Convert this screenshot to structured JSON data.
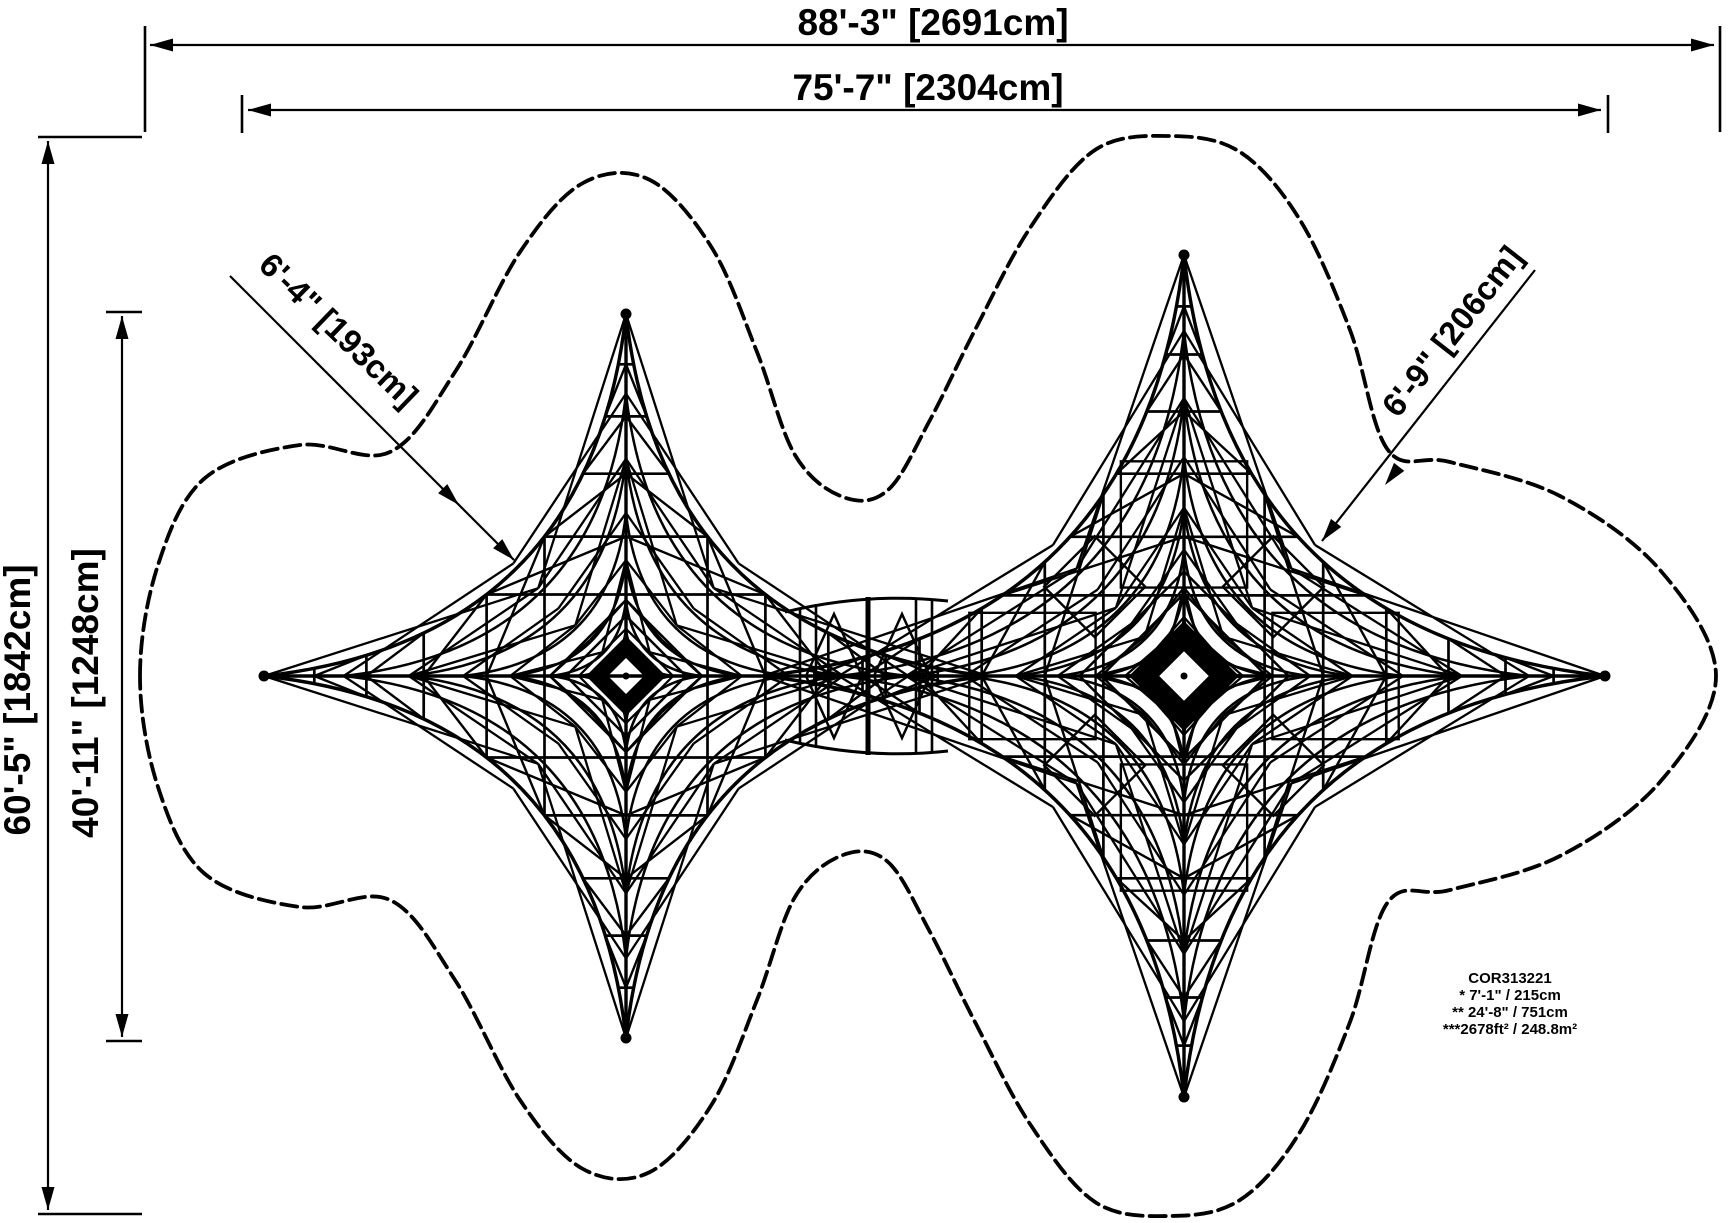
{
  "colors": {
    "ink": "#000000",
    "background": "#ffffff"
  },
  "dimensions": {
    "overall_width": "88'-3\" [2691cm]",
    "net_span_width": "75'-7\" [2304cm]",
    "overall_height": "60'-5\" [1842cm]",
    "net_span_height": "40'-11\" [1248cm]",
    "clearance_left": "6'-4\" [193cm]",
    "clearance_right": "6'-9\" [206cm]"
  },
  "product_note": {
    "model": "COR313221",
    "lines": [
      "* 7'-1\" / 215cm",
      "** 24'-8\" / 751cm",
      "***2678ft² / 248.8m²"
    ]
  }
}
